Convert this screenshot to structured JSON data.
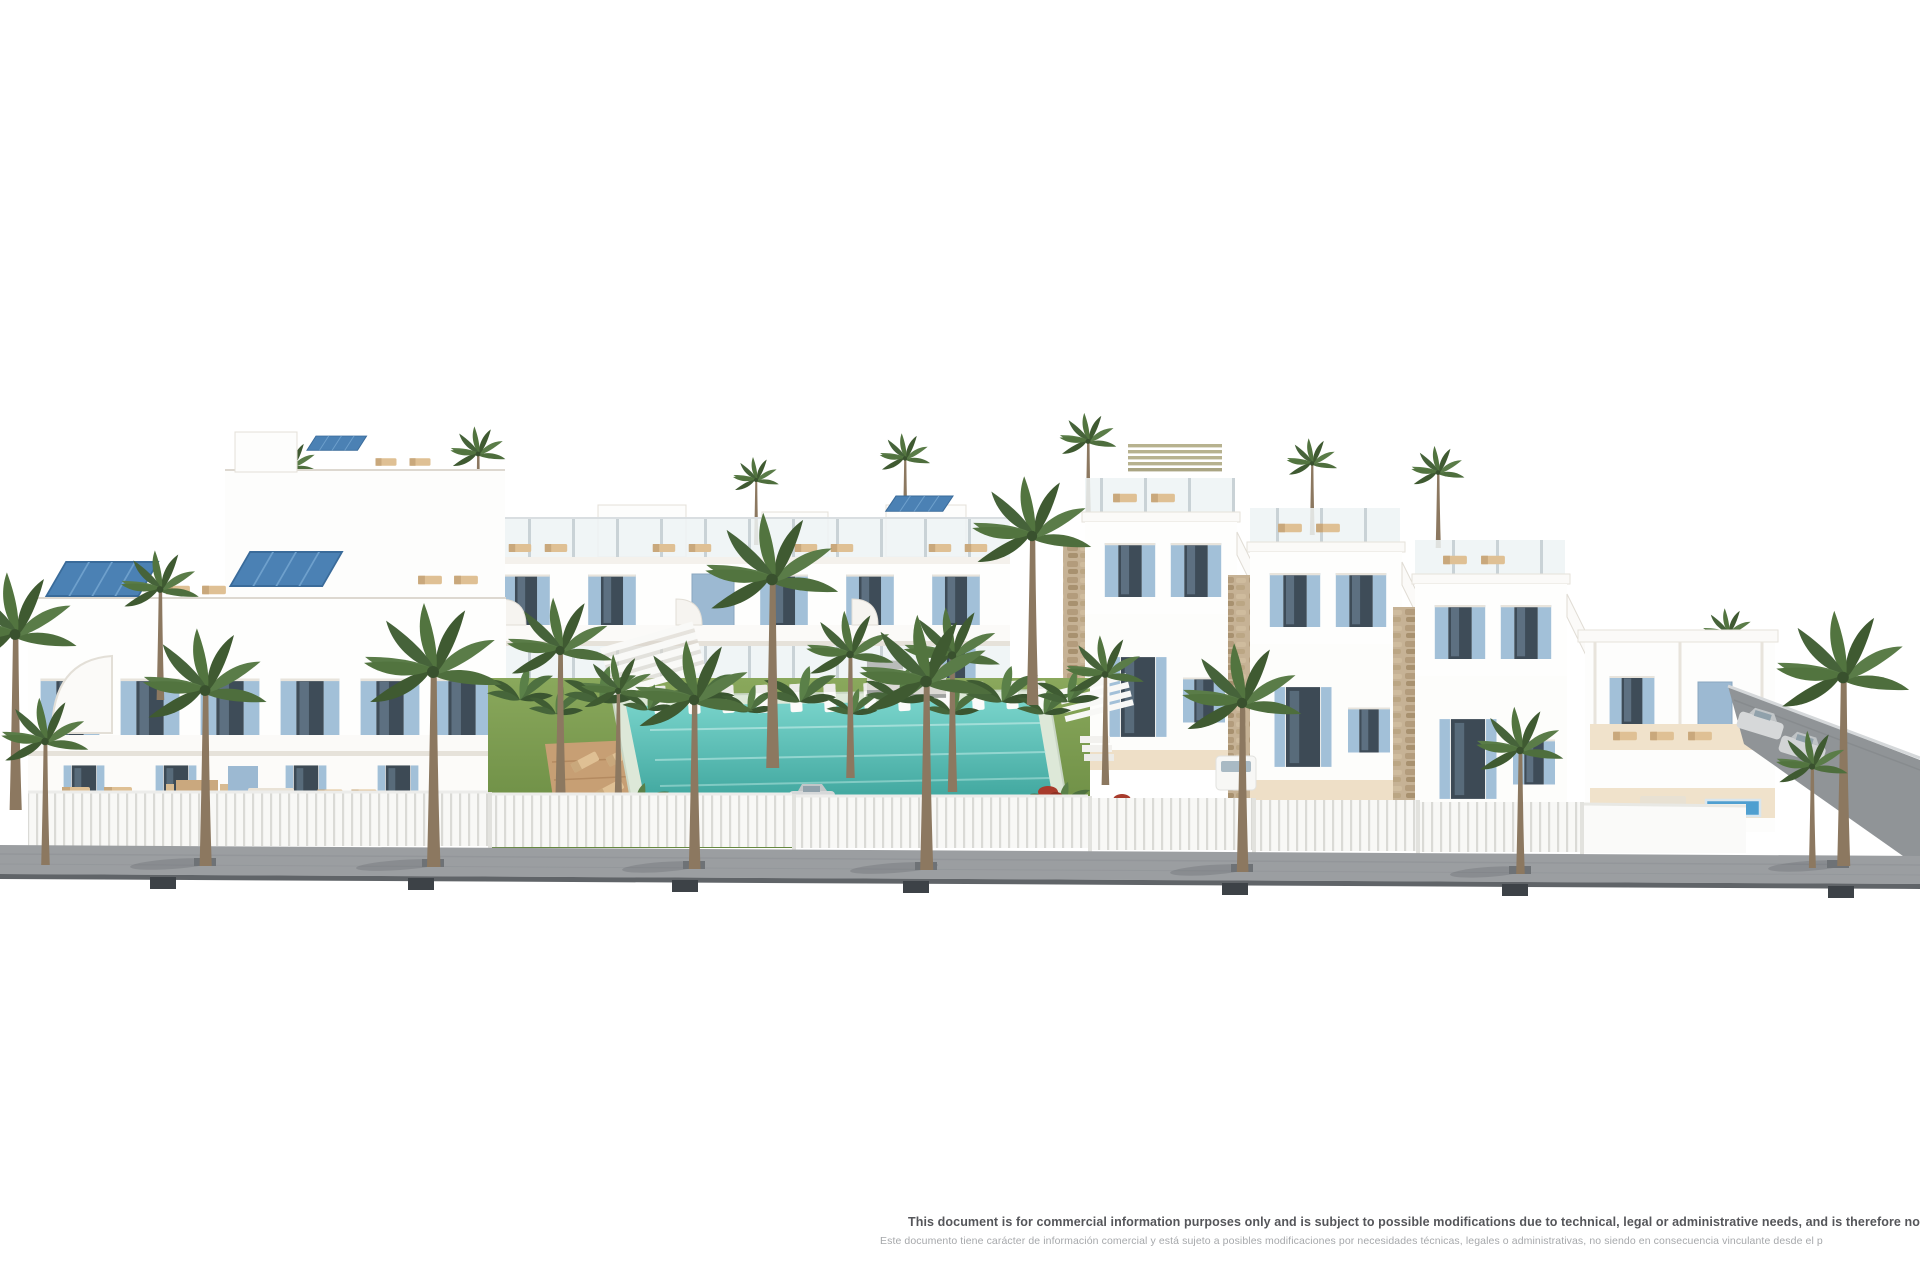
{
  "disclaimer": {
    "line_en": "This document is for commercial information purposes only and is subject to possible modifications due to technical, legal or administrative needs, and is therefore no",
    "line_es": "Este documento tiene carácter de información comercial y está sujeto a posibles modificaciones por necesidades técnicas, legales o administrativas, no siendo en consecuencia vinculante desde el p"
  },
  "palette": {
    "background_white": "#ffffff",
    "building_white": "#fdfdfc",
    "shutter_blue": "#9cb9d2",
    "solar_panel_blue": "#4b81b4",
    "glass_dark": "#3e4c58",
    "palm_green": "#50703f",
    "lawn_green": "#7a9a50",
    "pool_teal": "#5cc4bb",
    "deck_wood": "#c79f74",
    "terrace_cream": "#eedfc7",
    "stone_tan": "#c6b295",
    "sidewalk_gray": "#9b9ea1",
    "curb_dark": "#3d4247",
    "disclaimer_dark_gray": "#55565a",
    "disclaimer_light_gray": "#a6a8ab"
  }
}
